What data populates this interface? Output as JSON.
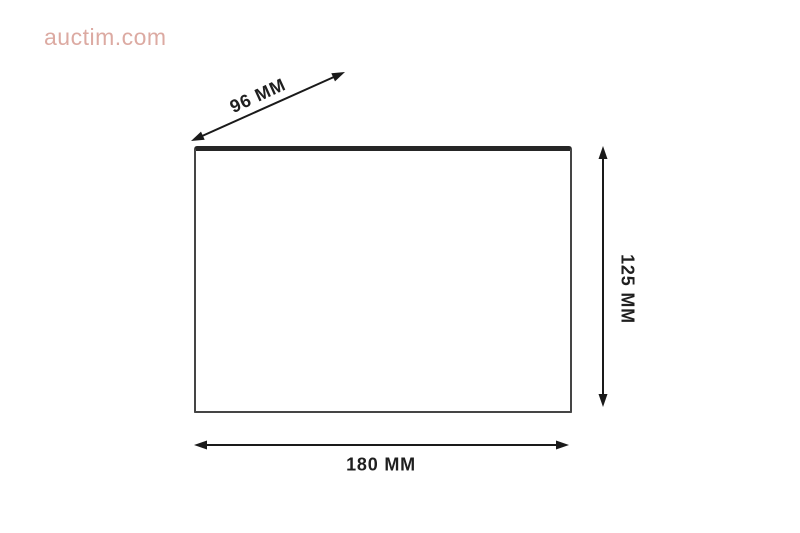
{
  "watermark": {
    "text": "auctim.com"
  },
  "diagram": {
    "dimensions": {
      "diagonal": {
        "label": "96 MM"
      },
      "height": {
        "label": "125 MM"
      },
      "width": {
        "label": "180 MM"
      }
    }
  },
  "theme": {
    "background": "#ffffff",
    "line": "#1a1a1a",
    "label_text": "#1f1f1f",
    "panel_border": "#454545",
    "panel_top": "#262626",
    "watermark": "#dcaaa2"
  }
}
